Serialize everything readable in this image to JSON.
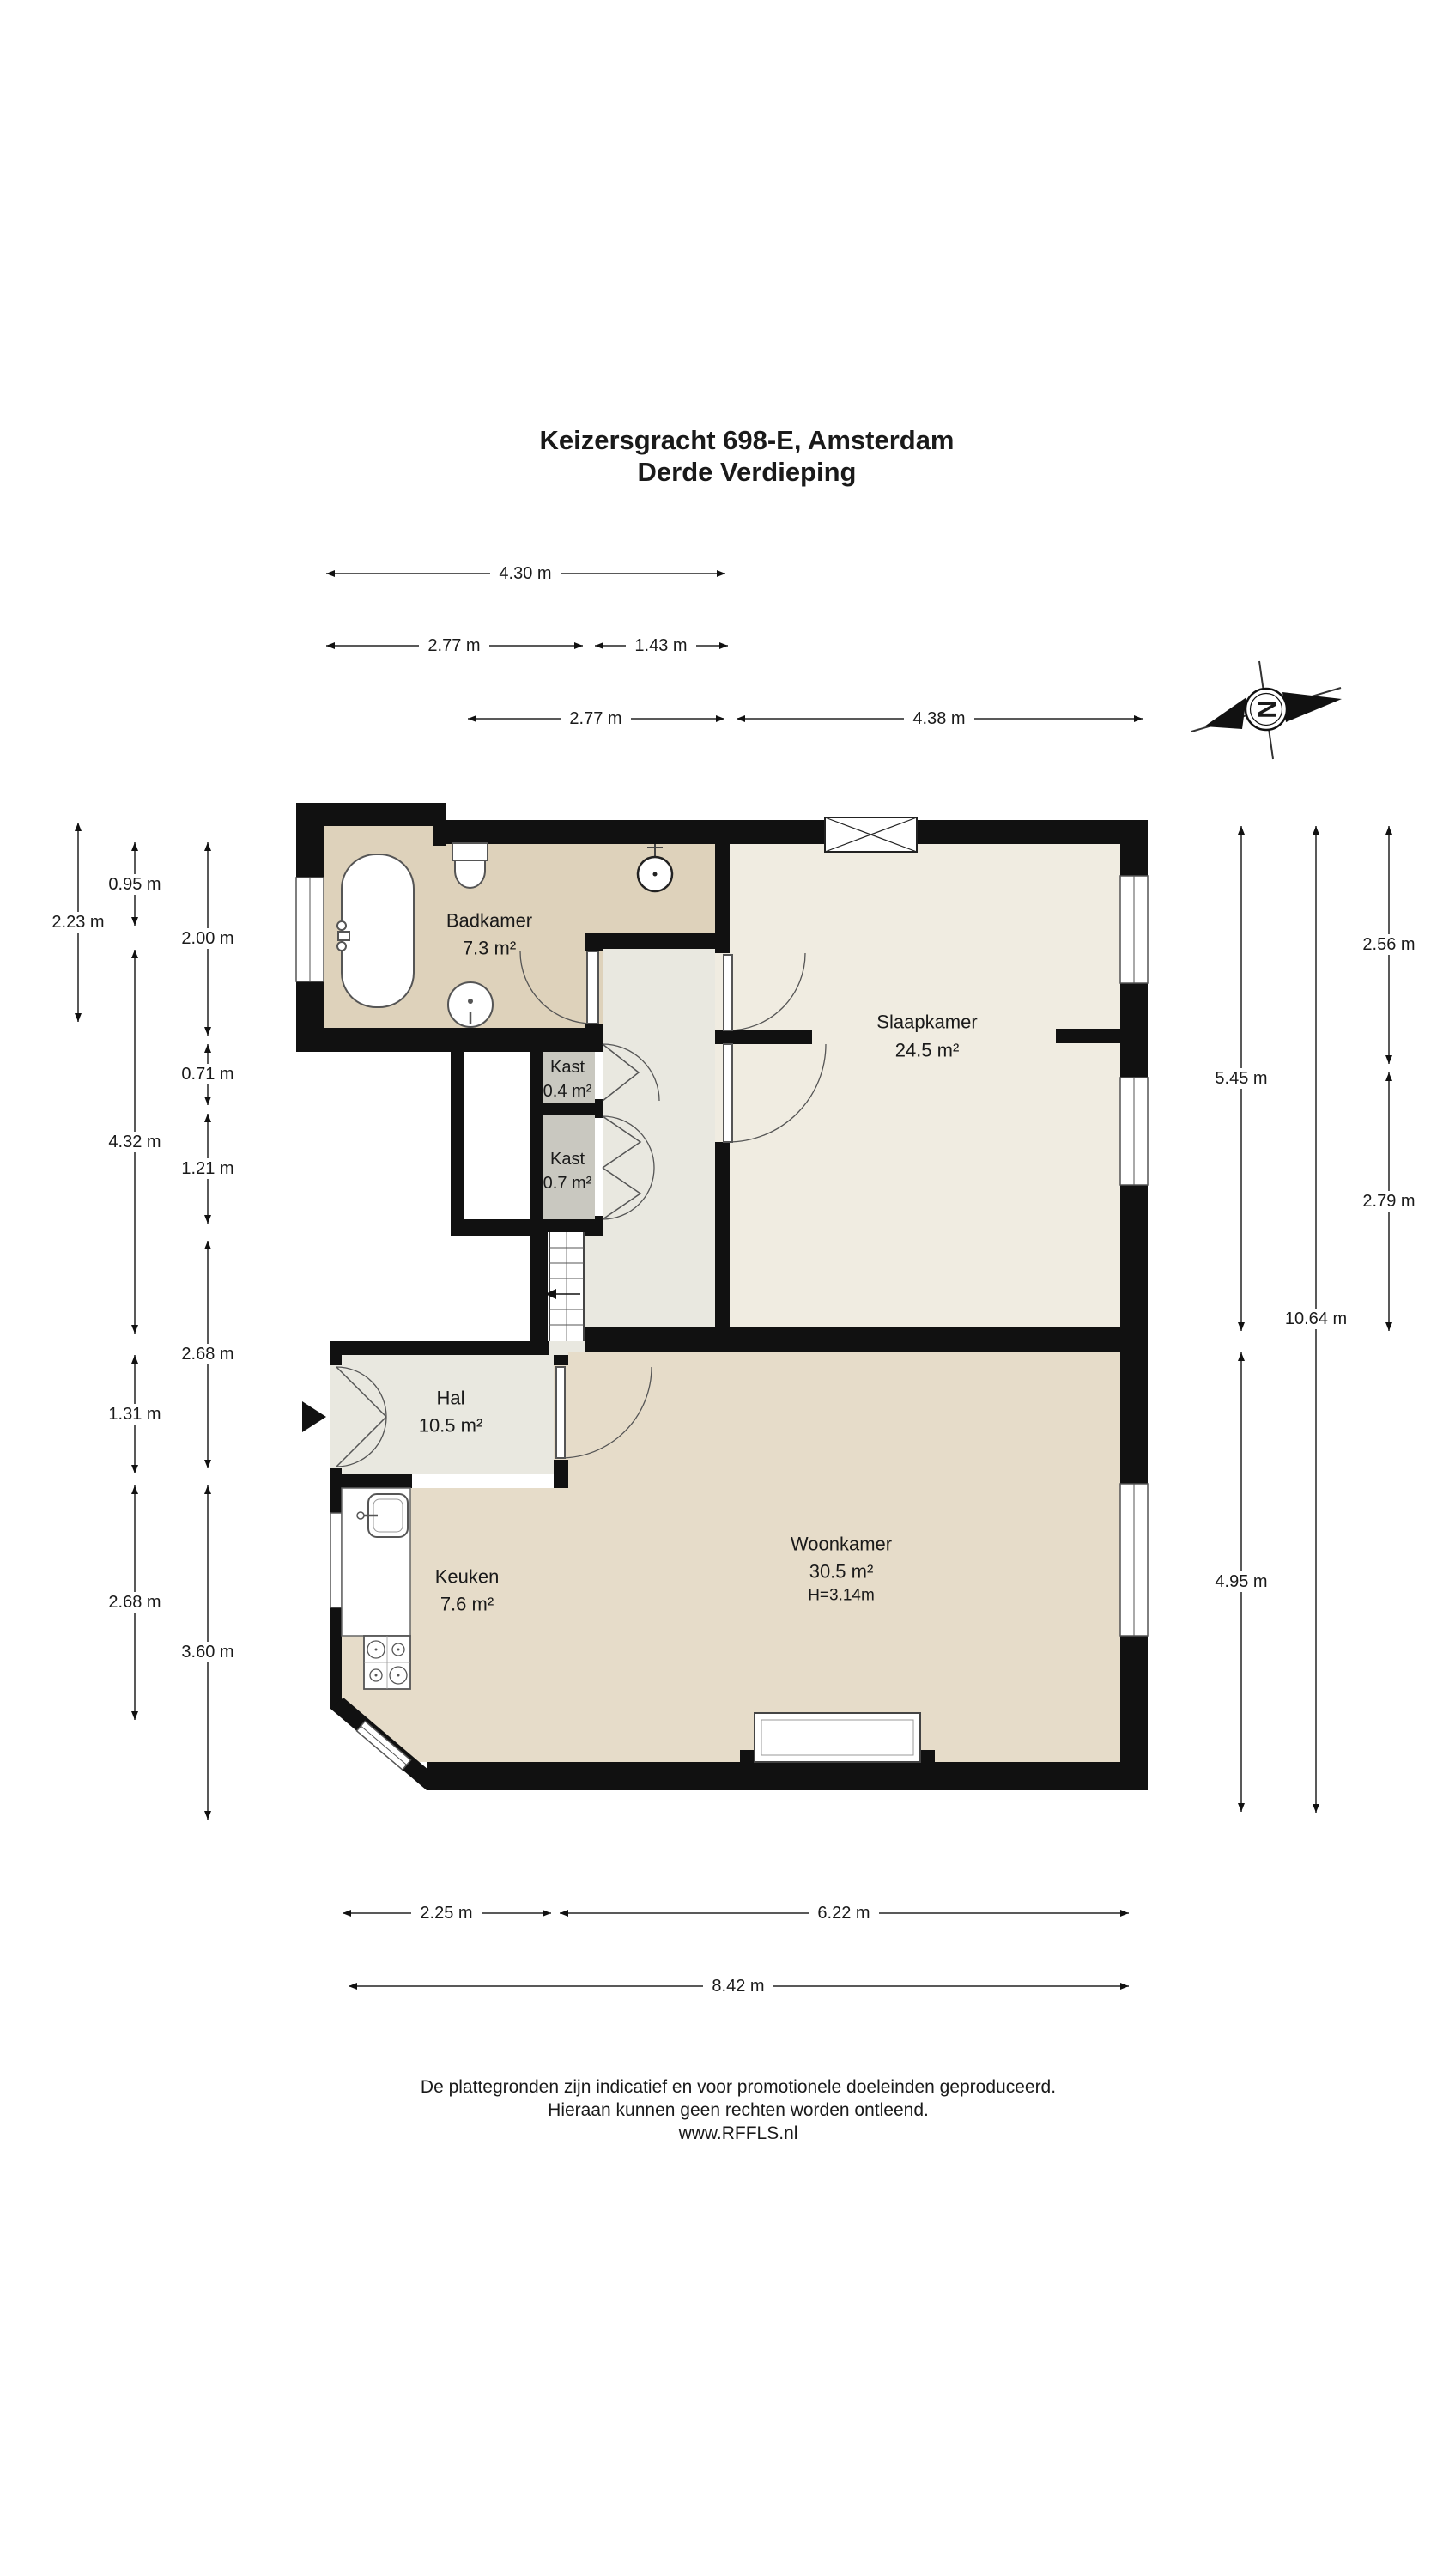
{
  "title": {
    "line1": "Keizersgracht 698-E, Amsterdam",
    "line2": "Derde Verdieping"
  },
  "compass": {
    "letter": "N"
  },
  "rooms": {
    "badkamer": {
      "name": "Badkamer",
      "area": "7.3 m²"
    },
    "kast1": {
      "name": "Kast",
      "area": "0.4 m²"
    },
    "kast2": {
      "name": "Kast",
      "area": "0.7 m²"
    },
    "slaapkamer": {
      "name": "Slaapkamer",
      "area": "24.5 m²"
    },
    "hal": {
      "name": "Hal",
      "area": "10.5 m²"
    },
    "keuken": {
      "name": "Keuken",
      "area": "7.6 m²"
    },
    "woonkamer": {
      "name": "Woonkamer",
      "area": "30.5 m²",
      "ceiling": "H=3.14m"
    }
  },
  "dims": {
    "top": [
      "4.30 m",
      "2.77 m",
      "1.43 m",
      "2.77 m",
      "4.38 m"
    ],
    "left": [
      "2.23 m",
      "0.95 m",
      "2.00 m",
      "0.71 m",
      "4.32 m",
      "1.21 m",
      "2.68 m",
      "1.31 m",
      "2.68 m",
      "3.60 m"
    ],
    "right": [
      "2.56 m",
      "5.45 m",
      "2.79 m",
      "10.64 m",
      "4.95 m"
    ],
    "bottom": [
      "2.25 m",
      "6.22 m",
      "8.42 m"
    ]
  },
  "footer": {
    "line1": "De plattegronden zijn indicatief en voor promotionele doeleinden geproduceerd.",
    "line2": "Hieraan kunnen geen rechten worden ontleend.",
    "line3": "www.RFFLS.nl"
  },
  "colors": {
    "wall": "#111111",
    "bath_floor": "#ded2bb",
    "bedroom_floor": "#f0ece1",
    "hall_floor": "#e9e8e0",
    "living_floor": "#e6dcc9",
    "closet_floor": "#c9c8c0"
  }
}
